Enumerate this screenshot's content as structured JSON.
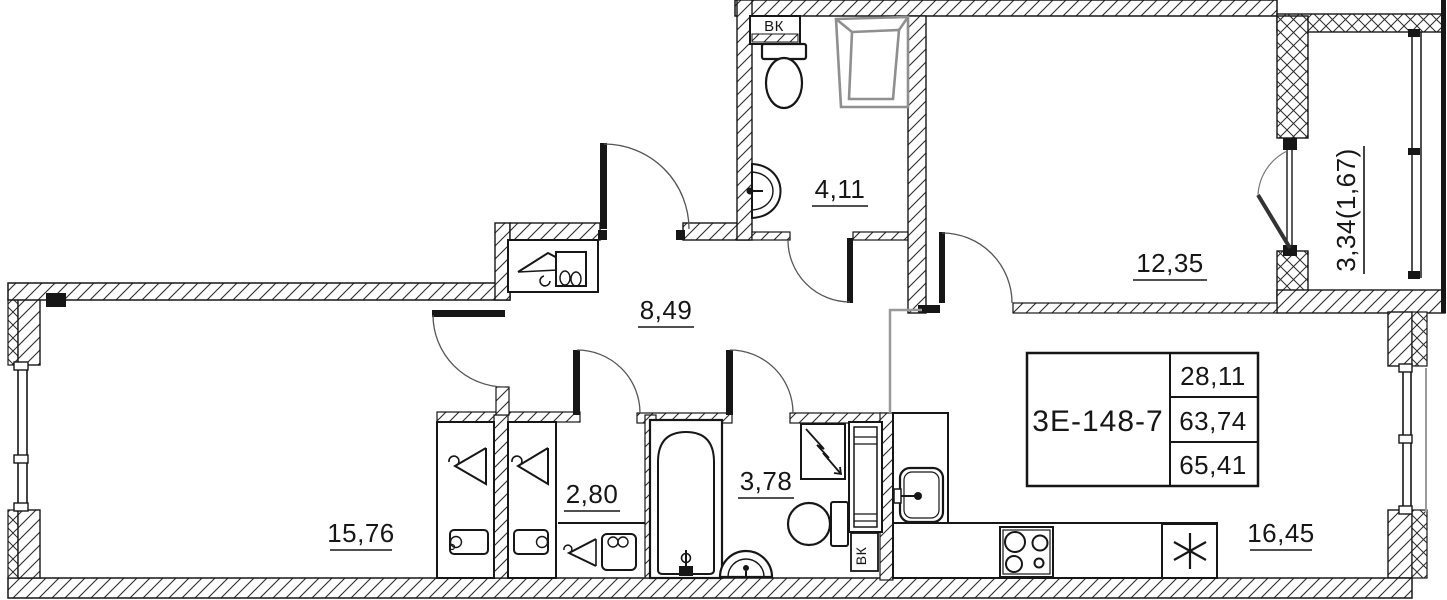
{
  "plan": {
    "unit": {
      "code": "3Е-148-7",
      "area_living": "28,11",
      "area_main": "63,74",
      "area_total": "65,41"
    },
    "rooms": {
      "bathroom_top": {
        "area": "4,11"
      },
      "bedroom": {
        "area": "12,35"
      },
      "balcony": {
        "area": "3,34(1,67)"
      },
      "hallway": {
        "area": "8,49"
      },
      "wardrobe": {
        "area": "2,80"
      },
      "bathroom_main": {
        "area": "3,78"
      },
      "living_room": {
        "area": "15,76"
      },
      "kitchen_living": {
        "area": "16,45"
      }
    },
    "shafts": {
      "top": "ВК",
      "bottom": "ВК"
    },
    "colors": {
      "line": "#161616",
      "fixture_gray": "#8f8f8f",
      "zone_line": "#999999",
      "background": "#ffffff"
    }
  }
}
